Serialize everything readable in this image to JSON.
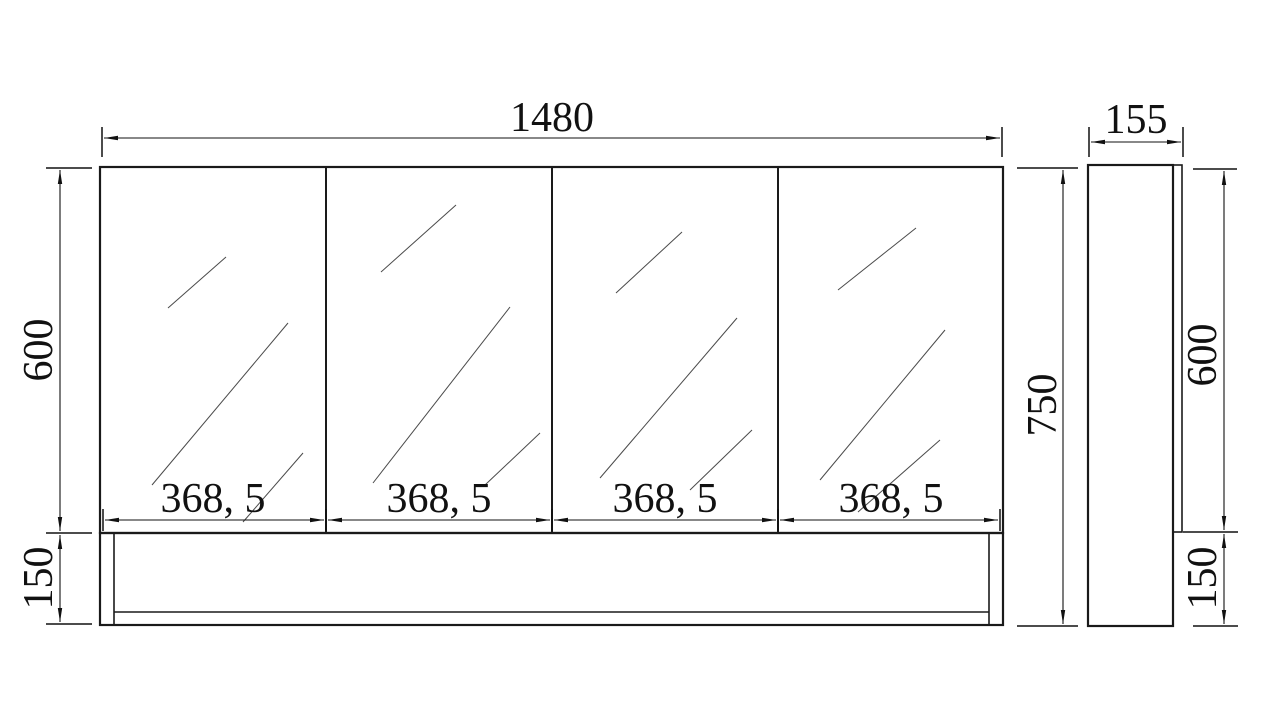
{
  "colors": {
    "background": "#ffffff",
    "object_line": "#1a1a1a",
    "dimension_line": "#111111",
    "glass_hatch_line": "#4a4a4a"
  },
  "front_view": {
    "total_width_label": "1480",
    "total_height_label": "750",
    "door_height_label": "600",
    "base_height_label": "150",
    "door_width_labels": [
      "368, 5",
      "368, 5",
      "368, 5",
      "368, 5"
    ]
  },
  "side_view": {
    "depth_label": "155",
    "door_height_label": "600",
    "base_height_label": "150"
  }
}
